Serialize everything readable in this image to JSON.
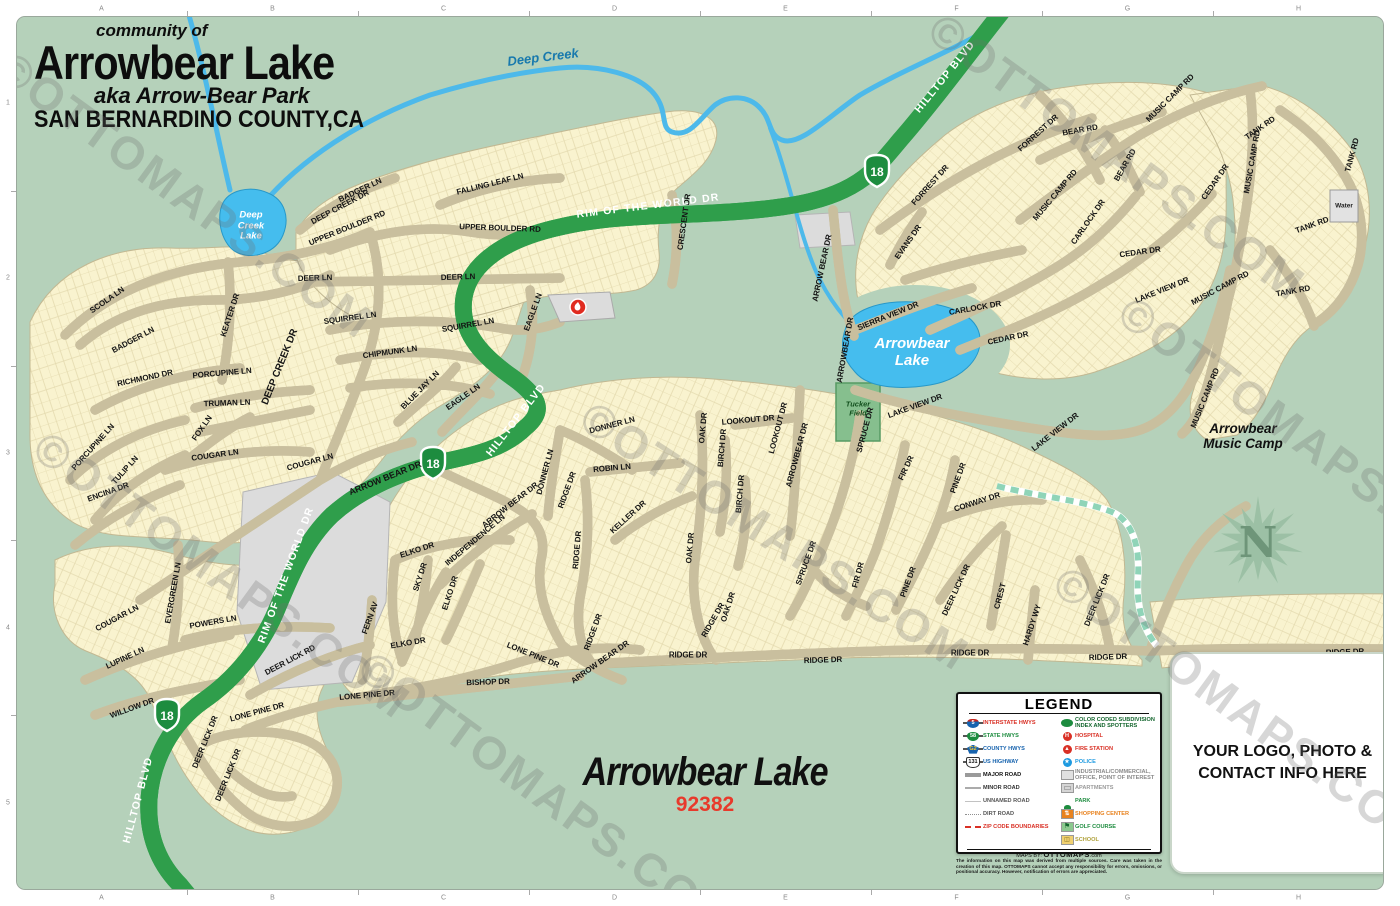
{
  "title": {
    "community_of": "community of",
    "name": "Arrowbear Lake",
    "aka": "aka Arrow-Bear Park",
    "county": "SAN BERNARDINO COUNTY,CA"
  },
  "bottom_title": {
    "name": "Arrowbear Lake",
    "zip": "92382"
  },
  "logo_box": {
    "line1": "YOUR LOGO, PHOTO &",
    "line2": "CONTACT INFO HERE"
  },
  "compass": {
    "label": "N"
  },
  "watermark": {
    "text": "©OTTOMAPS.COM",
    "spots": [
      {
        "x": 18,
        "y": 40,
        "r": 36
      },
      {
        "x": 55,
        "y": 420,
        "r": 36
      },
      {
        "x": 380,
        "y": 640,
        "r": 36
      },
      {
        "x": 600,
        "y": 390,
        "r": 33
      },
      {
        "x": 950,
        "y": 2,
        "r": 36
      },
      {
        "x": 1140,
        "y": 285,
        "r": 36
      },
      {
        "x": 1075,
        "y": 555,
        "r": 36
      }
    ]
  },
  "grid": {
    "columns": [
      "A",
      "B",
      "C",
      "D",
      "E",
      "F",
      "G",
      "H"
    ],
    "rows": [
      "1",
      "2",
      "3",
      "4",
      "5"
    ]
  },
  "legend": {
    "title": "LEGEND",
    "left_items": [
      {
        "icon": "interstate",
        "num": "5",
        "label": "INTERSTATE HWYS",
        "color": "#d93025"
      },
      {
        "icon": "state",
        "num": "58",
        "label": "STATE HWYS",
        "color": "#1d8c3f"
      },
      {
        "icon": "county",
        "num": "G2",
        "label": "COUNTY HWYS",
        "color": "#1763ae"
      },
      {
        "icon": "us",
        "num": "131",
        "label": "US HIGHWAY",
        "color": "#1763ae"
      },
      {
        "icon": "major",
        "label": "MAJOR ROAD",
        "color": "#111111"
      },
      {
        "icon": "minor",
        "label": "MINOR ROAD",
        "color": "#333333"
      },
      {
        "icon": "unnamed",
        "label": "UNNAMED ROAD",
        "color": "#555555"
      },
      {
        "icon": "dirt",
        "label": "DIRT ROAD",
        "color": "#555555"
      },
      {
        "icon": "zip",
        "label": "ZIP CODE BOUNDARIES",
        "color": "#d93025"
      }
    ],
    "right_items": [
      {
        "icon": "subdiv",
        "label": "COLOR CODED SUBDIVISION INDEX AND SPOTTERS",
        "color": "#14662e"
      },
      {
        "icon": "hospital",
        "label": "HOSPITAL",
        "color": "#d93025"
      },
      {
        "icon": "fire",
        "label": "FIRE STATION",
        "color": "#d93025"
      },
      {
        "icon": "police",
        "label": "POLICE",
        "color": "#1e9ae0"
      },
      {
        "icon": "industrial",
        "label": "INDUSTRIAL/COMMERCIAL, OFFICE, POINT OF INTEREST",
        "color": "#8a8a8a"
      },
      {
        "icon": "apartments",
        "label": "APARTMENTS",
        "color": "#9a9a9a"
      },
      {
        "icon": "park",
        "label": "PARK",
        "color": "#1d8c3f"
      },
      {
        "icon": "shopping",
        "label": "SHOPPING CENTER",
        "color": "#e8821e"
      },
      {
        "icon": "golf",
        "label": "GOLF COURSE",
        "color": "#1d8c3f"
      },
      {
        "icon": "school",
        "label": "SCHOOL",
        "color": "#b0a23c"
      }
    ],
    "credit_prefix": "MAPS BY:",
    "credit_brand": "OTTOMAPS",
    "credit_suffix": ".com",
    "disclaimer": "The information on this map was derived from multiple sources. Care was taken in the creation of this map. OTTOMAPS cannot accept any responsibility for errors, omissions, or positional accuracy. However, notification of errors are appreciated."
  },
  "map": {
    "places": {
      "deep_creek": {
        "l1": "Deep Creek"
      },
      "deep_creek_lake": {
        "l1": "Deep",
        "l2": "Creek",
        "l3": "Lake"
      },
      "arrowbear_lake": {
        "l1": "Arrowbear",
        "l2": "Lake"
      },
      "tucker_field": {
        "l1": "Tucker",
        "l2": "Field"
      },
      "music_camp": {
        "l1": "Arrowbear",
        "l2": "Music Camp"
      },
      "water": {
        "l1": "Water"
      }
    },
    "route_shields": [
      {
        "label": "18",
        "x": 877,
        "y": 170
      },
      {
        "label": "18",
        "x": 433,
        "y": 462
      },
      {
        "label": "18",
        "x": 167,
        "y": 714
      }
    ],
    "street_labels": [
      {
        "t": "SCOLA LN",
        "x": 107,
        "y": 300,
        "r": -35
      },
      {
        "t": "BADGER LN",
        "x": 133,
        "y": 340,
        "r": -28
      },
      {
        "t": "BADGER LN",
        "x": 360,
        "y": 190,
        "r": -25
      },
      {
        "t": "KEATER DR",
        "x": 230,
        "y": 315,
        "r": -72
      },
      {
        "t": "DEER LN",
        "x": 315,
        "y": 278,
        "r": -2
      },
      {
        "t": "DEER LN",
        "x": 458,
        "y": 277,
        "r": -2
      },
      {
        "t": "DEEP CREEK DR",
        "x": 340,
        "y": 207,
        "r": -28
      },
      {
        "t": "UPPER BOULDER RD",
        "x": 347,
        "y": 228,
        "r": -22
      },
      {
        "t": "UPPER BOULDER RD",
        "x": 500,
        "y": 228,
        "r": 2
      },
      {
        "t": "FALLING LEAF LN",
        "x": 490,
        "y": 184,
        "r": -14
      },
      {
        "t": "SQUIRREL LN",
        "x": 350,
        "y": 318,
        "r": -8
      },
      {
        "t": "SQUIRREL LN",
        "x": 468,
        "y": 325,
        "r": -10
      },
      {
        "t": "CHIPMUNK LN",
        "x": 390,
        "y": 352,
        "r": -8
      },
      {
        "t": "BLUE JAY LN",
        "x": 420,
        "y": 390,
        "r": -45
      },
      {
        "t": "EAGLE LN",
        "x": 463,
        "y": 397,
        "r": -35
      },
      {
        "t": "EAGLE LN",
        "x": 533,
        "y": 312,
        "r": -70
      },
      {
        "t": "RICHMOND DR",
        "x": 145,
        "y": 378,
        "r": -12
      },
      {
        "t": "PORCUPINE LN",
        "x": 222,
        "y": 373,
        "r": -5
      },
      {
        "t": "PORCUPINE LN",
        "x": 93,
        "y": 447,
        "r": -48
      },
      {
        "t": "TRUMAN LN",
        "x": 227,
        "y": 403,
        "r": -2
      },
      {
        "t": "FOX LN",
        "x": 202,
        "y": 428,
        "r": -55
      },
      {
        "t": "TULIP LN",
        "x": 125,
        "y": 470,
        "r": -48
      },
      {
        "t": "COUGAR LN",
        "x": 215,
        "y": 455,
        "r": -8
      },
      {
        "t": "COUGAR LN",
        "x": 310,
        "y": 462,
        "r": -15
      },
      {
        "t": "COUGAR LN",
        "x": 117,
        "y": 618,
        "r": -28
      },
      {
        "t": "ENCINA DR",
        "x": 108,
        "y": 492,
        "r": -20
      },
      {
        "t": "EVERGREEN LN",
        "x": 173,
        "y": 593,
        "r": -80
      },
      {
        "t": "LUPINE LN",
        "x": 125,
        "y": 658,
        "r": -25
      },
      {
        "t": "WILLOW DR",
        "x": 132,
        "y": 708,
        "r": -20
      },
      {
        "t": "POWERS LN",
        "x": 213,
        "y": 622,
        "r": -10
      },
      {
        "t": "DEER LICK RD",
        "x": 290,
        "y": 660,
        "r": -28
      },
      {
        "t": "DEER LICK DR",
        "x": 205,
        "y": 742,
        "r": -68
      },
      {
        "t": "DEER LICK DR",
        "x": 228,
        "y": 775,
        "r": -68
      },
      {
        "t": "LONE PINE DR",
        "x": 257,
        "y": 712,
        "r": -15
      },
      {
        "t": "LONE PINE DR",
        "x": 367,
        "y": 695,
        "r": -5
      },
      {
        "t": "LONE PINE DR",
        "x": 533,
        "y": 655,
        "r": 22
      },
      {
        "t": "FERN AV",
        "x": 370,
        "y": 618,
        "r": -70
      },
      {
        "t": "BISHOP DR",
        "x": 488,
        "y": 682,
        "r": -2
      },
      {
        "t": "ELKO DR",
        "x": 417,
        "y": 550,
        "r": -18
      },
      {
        "t": "ELKO DR",
        "x": 450,
        "y": 593,
        "r": -72
      },
      {
        "t": "ELKO DR",
        "x": 408,
        "y": 643,
        "r": -10
      },
      {
        "t": "SKY DR",
        "x": 420,
        "y": 577,
        "r": -72
      },
      {
        "t": "INDEPENDENCE LN",
        "x": 475,
        "y": 540,
        "r": -40
      },
      {
        "t": "ARROW BEAR DR",
        "x": 385,
        "y": 478,
        "r": -22,
        "s": 9
      },
      {
        "t": "ARROW BEAR DR",
        "x": 510,
        "y": 505,
        "r": -38
      },
      {
        "t": "ARROW BEAR DR",
        "x": 600,
        "y": 662,
        "r": -35
      },
      {
        "t": "ARROWBEAR DR",
        "x": 797,
        "y": 455,
        "r": -75
      },
      {
        "t": "ARROWBEAR DR",
        "x": 845,
        "y": 350,
        "r": -80
      },
      {
        "t": "ARROW BEAR DR",
        "x": 822,
        "y": 268,
        "r": -78
      },
      {
        "t": "DEEP CREEK DR",
        "x": 280,
        "y": 367,
        "r": -68,
        "s": 10
      },
      {
        "t": "DONNER LN",
        "x": 612,
        "y": 425,
        "r": -15
      },
      {
        "t": "DONNER LN",
        "x": 545,
        "y": 472,
        "r": -75
      },
      {
        "t": "ROBIN LN",
        "x": 612,
        "y": 468,
        "r": -5
      },
      {
        "t": "RIDGE DR",
        "x": 567,
        "y": 490,
        "r": -70
      },
      {
        "t": "RIDGE DR",
        "x": 577,
        "y": 550,
        "r": -85
      },
      {
        "t": "RIDGE DR",
        "x": 593,
        "y": 632,
        "r": -70
      },
      {
        "t": "RIDGE DR",
        "x": 713,
        "y": 620,
        "r": -60
      },
      {
        "t": "RIDGE DR",
        "x": 688,
        "y": 655,
        "r": 0
      },
      {
        "t": "RIDGE DR",
        "x": 823,
        "y": 660,
        "r": -2
      },
      {
        "t": "RIDGE DR",
        "x": 970,
        "y": 653,
        "r": 0
      },
      {
        "t": "RIDGE DR",
        "x": 1108,
        "y": 657,
        "r": -2
      },
      {
        "t": "RIDGE DR",
        "x": 1345,
        "y": 652,
        "r": -2
      },
      {
        "t": "KELLER DR",
        "x": 628,
        "y": 517,
        "r": -42
      },
      {
        "t": "OAK DR",
        "x": 703,
        "y": 428,
        "r": -85
      },
      {
        "t": "OAK DR",
        "x": 690,
        "y": 548,
        "r": -85
      },
      {
        "t": "OAK DR",
        "x": 728,
        "y": 607,
        "r": -72
      },
      {
        "t": "LOOKOUT DR",
        "x": 748,
        "y": 420,
        "r": -5
      },
      {
        "t": "LOOKOUT DR",
        "x": 778,
        "y": 428,
        "r": -75
      },
      {
        "t": "BIRCH DR",
        "x": 722,
        "y": 448,
        "r": -85
      },
      {
        "t": "BIRCH DR",
        "x": 740,
        "y": 494,
        "r": -85
      },
      {
        "t": "SPRUCE DR",
        "x": 865,
        "y": 430,
        "r": -75
      },
      {
        "t": "SPRUCE DR",
        "x": 806,
        "y": 563,
        "r": -70
      },
      {
        "t": "FIR DR",
        "x": 906,
        "y": 468,
        "r": -65
      },
      {
        "t": "FIR DR",
        "x": 858,
        "y": 575,
        "r": -75
      },
      {
        "t": "PINE DR",
        "x": 958,
        "y": 478,
        "r": -70
      },
      {
        "t": "PINE DR",
        "x": 908,
        "y": 582,
        "r": -70
      },
      {
        "t": "CONWAY DR",
        "x": 977,
        "y": 502,
        "r": -18
      },
      {
        "t": "DEER LICK DR",
        "x": 956,
        "y": 590,
        "r": -65
      },
      {
        "t": "DEER LICK DR",
        "x": 1097,
        "y": 600,
        "r": -68
      },
      {
        "t": "CREST",
        "x": 1000,
        "y": 596,
        "r": -75
      },
      {
        "t": "HARDY WY",
        "x": 1032,
        "y": 625,
        "r": -72
      },
      {
        "t": "LAKE VIEW DR",
        "x": 915,
        "y": 406,
        "r": -20
      },
      {
        "t": "LAKE VIEW DR",
        "x": 1055,
        "y": 432,
        "r": -38
      },
      {
        "t": "LAKE VIEW DR",
        "x": 1162,
        "y": 290,
        "r": -22
      },
      {
        "t": "SIERRA VIEW DR",
        "x": 888,
        "y": 316,
        "r": -22
      },
      {
        "t": "CARLOCK DR",
        "x": 975,
        "y": 308,
        "r": -10
      },
      {
        "t": "CARLOCK DR",
        "x": 1088,
        "y": 222,
        "r": -55
      },
      {
        "t": "CEDAR DR",
        "x": 1008,
        "y": 338,
        "r": -12
      },
      {
        "t": "CEDAR DR",
        "x": 1140,
        "y": 252,
        "r": -8
      },
      {
        "t": "CEDAR DR",
        "x": 1215,
        "y": 182,
        "r": -55
      },
      {
        "t": "EVANS DR",
        "x": 908,
        "y": 242,
        "r": -55
      },
      {
        "t": "FORREST DR",
        "x": 930,
        "y": 185,
        "r": -48
      },
      {
        "t": "FORREST DR",
        "x": 1038,
        "y": 133,
        "r": -42
      },
      {
        "t": "BEAR RD",
        "x": 1080,
        "y": 130,
        "r": -10
      },
      {
        "t": "BEAR RD",
        "x": 1125,
        "y": 165,
        "r": -60
      },
      {
        "t": "MUSIC CAMP RD",
        "x": 1055,
        "y": 195,
        "r": -50
      },
      {
        "t": "MUSIC CAMP RD",
        "x": 1170,
        "y": 98,
        "r": -45
      },
      {
        "t": "MUSIC CAMP RD",
        "x": 1252,
        "y": 162,
        "r": -80
      },
      {
        "t": "MUSIC CAMP RD",
        "x": 1220,
        "y": 288,
        "r": -28
      },
      {
        "t": "MUSIC CAMP RD",
        "x": 1205,
        "y": 398,
        "r": -68
      },
      {
        "t": "TANK RD",
        "x": 1260,
        "y": 128,
        "r": -35
      },
      {
        "t": "TANK RD",
        "x": 1352,
        "y": 155,
        "r": -75
      },
      {
        "t": "TANK RD",
        "x": 1312,
        "y": 225,
        "r": -20
      },
      {
        "t": "TANK RD",
        "x": 1293,
        "y": 291,
        "r": -10
      },
      {
        "t": "CRESCENT DR",
        "x": 684,
        "y": 222,
        "r": -82
      },
      {
        "t": "HILLTOP BLVD",
        "x": 945,
        "y": 77,
        "r": -51,
        "k": "w"
      },
      {
        "t": "RIM OF THE WORLD DR",
        "x": 648,
        "y": 206,
        "r": -7,
        "k": "w"
      },
      {
        "t": "HILLTOP BLVD",
        "x": 516,
        "y": 420,
        "r": -52,
        "k": "w"
      },
      {
        "t": "RIM OF THE WORLD DR",
        "x": 286,
        "y": 575,
        "r": -70,
        "k": "w"
      },
      {
        "t": "HILLTOP BLVD",
        "x": 138,
        "y": 800,
        "r": -75,
        "k": "w"
      }
    ]
  }
}
